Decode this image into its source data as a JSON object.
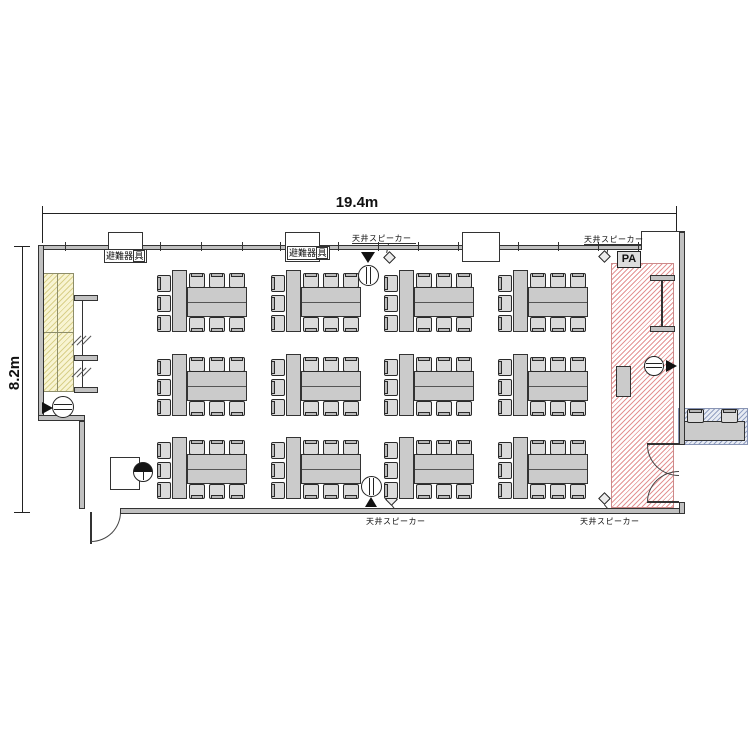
{
  "dimensions": {
    "width": "19.4m",
    "height": "8.2m"
  },
  "annotations": {
    "evacuation_equipment": {
      "prefix": "避難器",
      "boxed_char": "具"
    },
    "ceiling_speaker": "天井スピーカー",
    "pa": "PA"
  },
  "furniture": {
    "grid": {
      "rows": 3,
      "columns": 4
    },
    "chairs_per_group": {
      "left": 3,
      "top": 3,
      "bottom": 3
    }
  },
  "colors": {
    "stage_hatch": "#e49494",
    "whiteboard_fill": "#f8f4d2",
    "whiteboard_hatch": "#d9d08a",
    "console_hatch": "#92a0c2",
    "table_fill": "#cbcbcb",
    "wall_fill": "#c0c0c0"
  }
}
